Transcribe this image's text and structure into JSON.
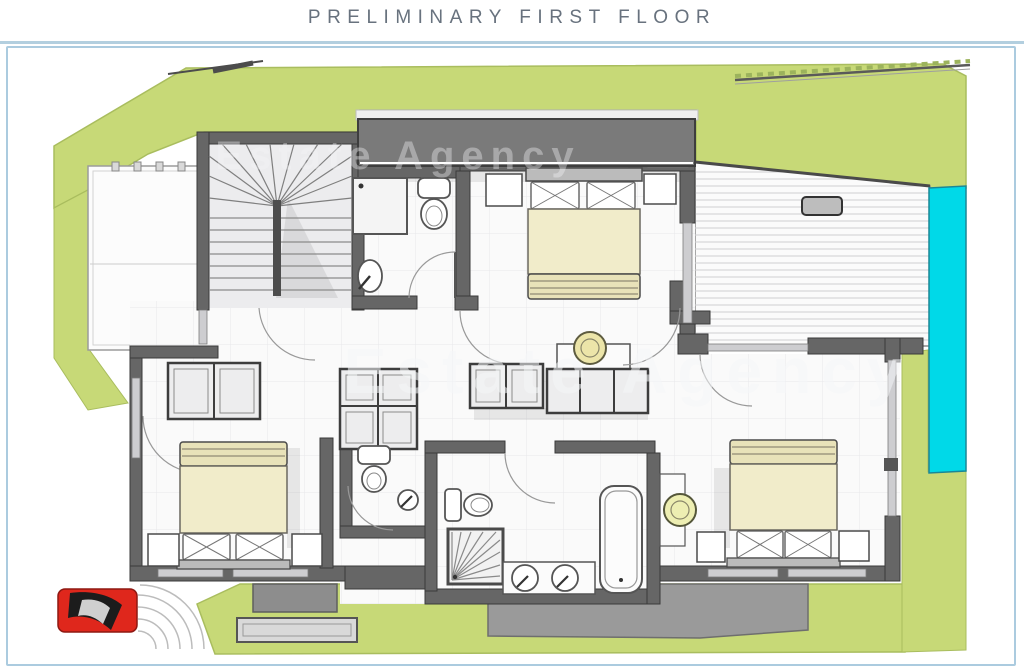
{
  "header": {
    "title": "PRELIMINARY FIRST FLOOR"
  },
  "watermark": {
    "text": "Estate Agency"
  },
  "palette": {
    "title_color": "#68727e",
    "rule": "#b3cfdf",
    "frame_border": "#abcbdf",
    "lawn": "#c7d977",
    "lawn_edge": "#a9bd5e",
    "pool": "#00d9e8",
    "wall": "#666666",
    "window": "#cdcdd0",
    "canopy": "#7a7a7a",
    "room_floor": "#fafafa",
    "bed_linen": "#f1ecca",
    "bed_roll": "#e8e2b9",
    "paving": "#9a9a9a",
    "car": "#df271c",
    "chair": "#edeeb2"
  },
  "legend_items": [
    "staircase",
    "double-bed",
    "wardrobe",
    "toilet",
    "washbasin",
    "double-washbasin",
    "bathtub",
    "corner-shower",
    "swimming-pool",
    "wood-deck",
    "terrace",
    "lawn",
    "car",
    "paved-patio"
  ]
}
